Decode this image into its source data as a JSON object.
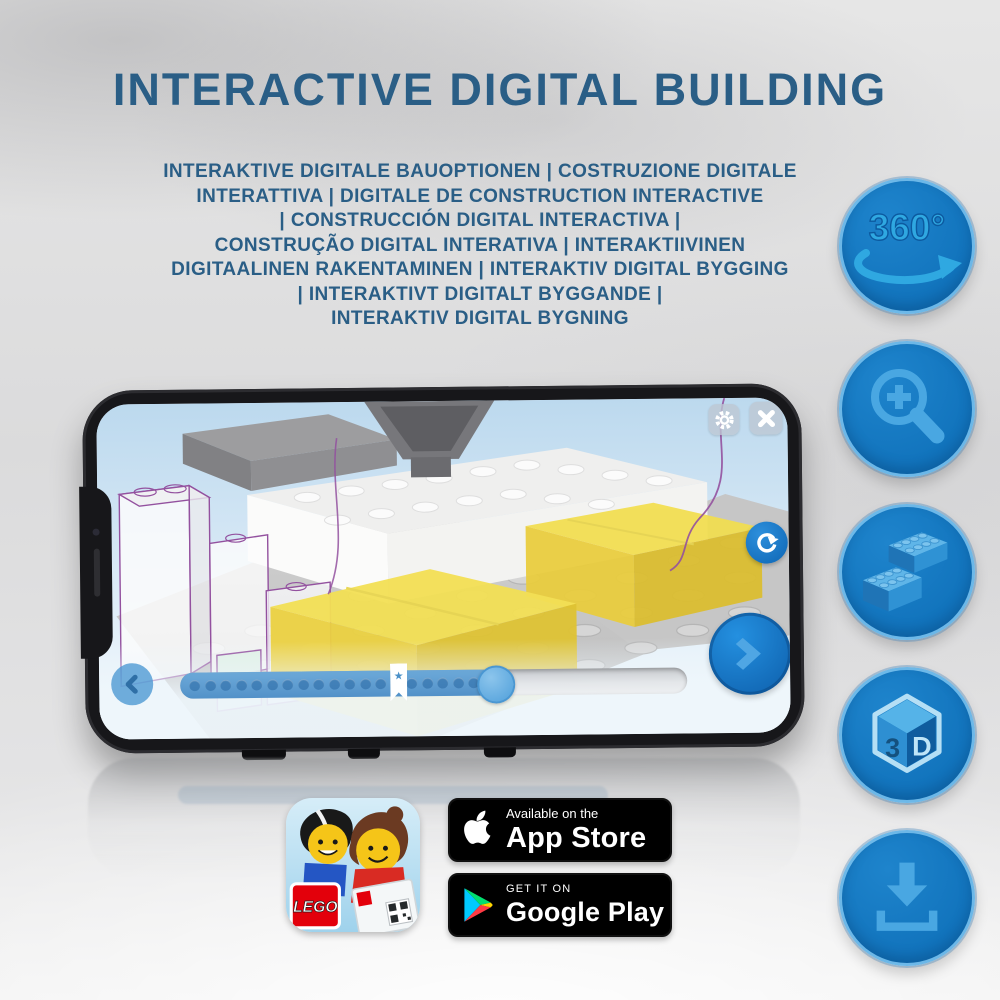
{
  "header": {
    "title": "INTERACTIVE DIGITAL BUILDING",
    "subtitle_lines": [
      "INTERAKTIVE DIGITALE BAUOPTIONEN | COSTRUZIONE DIGITALE",
      "INTERATTIVA | DIGITALE DE CONSTRUCTION INTERACTIVE",
      "| CONSTRUCCIÓN DIGITAL INTERACTIVA |",
      "CONSTRUÇÃO DIGITAL INTERATIVA | INTERAKTIIVINEN",
      "DIGITAALINEN RAKENTAMINEN | INTERAKTIV DIGITAL BYGGING",
      "| INTERAKTIVT DIGITALT BYGGANDE |",
      "INTERAKTIV DIGITAL BYGNING"
    ]
  },
  "feature_icons": [
    {
      "id": "rotate-360",
      "label": "360°",
      "glyph": "360-rotation-arrow"
    },
    {
      "id": "zoom-in",
      "glyph": "magnifier-plus"
    },
    {
      "id": "building-bricks",
      "glyph": "two-lego-bricks"
    },
    {
      "id": "view-3d",
      "digit": "3",
      "letter": "D",
      "glyph": "3d-cube"
    },
    {
      "id": "download",
      "glyph": "download-arrow-tray"
    }
  ],
  "phone_screen": {
    "toolbar_icons": [
      "settings-gear",
      "close-x"
    ],
    "rotate_button_icon": "rotate-clockwise-arrow",
    "nav_icons": {
      "back": "chevron-left",
      "next": "chevron-right"
    },
    "progress": {
      "percent": 62,
      "bookmark_percent": 43,
      "dots": 20
    }
  },
  "store": {
    "app_icon_logo": "LEGO",
    "app_store_badge": {
      "line1": "Available on the",
      "line2": "App Store"
    },
    "google_play_badge": {
      "line1": "GET IT ON",
      "line2": "Google Play"
    }
  },
  "colors": {
    "title_text": "#2A5E86",
    "icon_circle": "#1173BC",
    "icon_glyph": "#45A5E2",
    "next_button": "#1269B6",
    "yellow_brick": "#F3E055"
  }
}
